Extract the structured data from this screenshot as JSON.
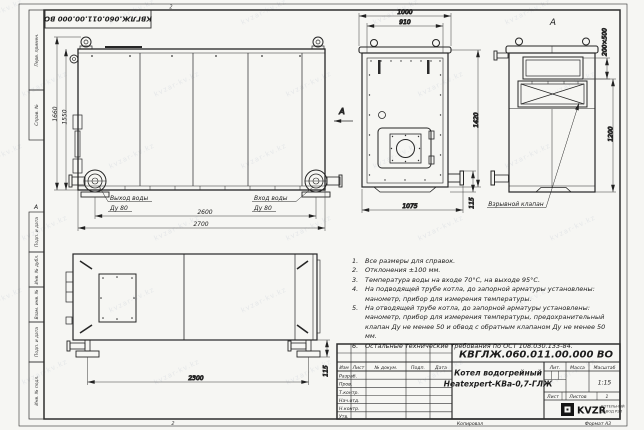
{
  "watermark": {
    "text": "kvzar-kv.kz"
  },
  "frame": {
    "stamp": "КВГЛЖ.060.011.00.000 ВО",
    "zone_letter": "А",
    "fold_mark": "2",
    "left_labels": [
      "Перв. примен.",
      "Справ. №",
      "Подп. и дата",
      "Инв. № дубл.",
      "Взам. инв. №",
      "Подп. и дата",
      "Инв. № подл."
    ],
    "copy_label": "Копировал",
    "format_label": "Формат А3"
  },
  "views": {
    "front": {
      "dim_height_outer": "1660",
      "dim_height_inner": "1550",
      "dim_width_inner": "2600",
      "dim_width_outer": "2700",
      "outlet_line1": "Выход воды",
      "outlet_line2": "Ду 80",
      "inlet_line1": "Вход воды",
      "inlet_line2": "Ду 80"
    },
    "side": {
      "view_marker": "А",
      "dim_top_outer": "1000",
      "dim_top_inner": "910",
      "dim_height": "1420",
      "dim_bottom": "1075",
      "dim_flange": "115"
    },
    "back": {
      "label": "А",
      "dim_window": "200×500",
      "dim_height": "1200",
      "valve_label": "Взрывной клапан"
    },
    "plan": {
      "dim_length": "2300",
      "dim_offset": "115"
    }
  },
  "notes": [
    {
      "num": "1.",
      "text": "Все размеры для справок."
    },
    {
      "num": "2.",
      "text": "Отклонения ±100 мм."
    },
    {
      "num": "3.",
      "text": "Температура воды на входе 70°С, на выходе 95°С."
    },
    {
      "num": "4.",
      "text": "На подводящей трубе котла, до запорной арматуры установлены: манометр, прибор для измерения температуры."
    },
    {
      "num": "5.",
      "text": "На отводящей трубе котла, до запорной арматуры установлены: манометр, прибор для измерения температуры, предохранительный клапан Ду не менее 50 и обвод с обратным клапаном Ду не менее 50 мм."
    },
    {
      "num": "6.",
      "text": "Остальные технические требования по ОСТ 108.030.133-84."
    }
  ],
  "title_block": {
    "doc_number": "КВГЛЖ.060.011.00.000 ВО",
    "title_line1": "Котел водогрейный",
    "title_line2": "Heatexpert-КВа-0,7-ГЛЖ",
    "col_izm": "Изм",
    "col_list": "Лист",
    "col_doc": "№ докум.",
    "col_sign": "Подп.",
    "col_date": "Дата",
    "rows": [
      "Разраб.",
      "Пров.",
      "Т.контр.",
      "Нач.отд.",
      "Н.контр.",
      "Утв."
    ],
    "lit_label": "Лит.",
    "mass_label": "Масса",
    "scale_label": "Масштаб",
    "scale_value": "1:15",
    "sheet_label": "Лист",
    "sheets_label": "Листов",
    "sheets_value": "1",
    "logo_text": "KVZR",
    "logo_sub1": "КОТЕЛЬНЫЙ",
    "logo_sub2": "ЗАВОД РЭП"
  }
}
